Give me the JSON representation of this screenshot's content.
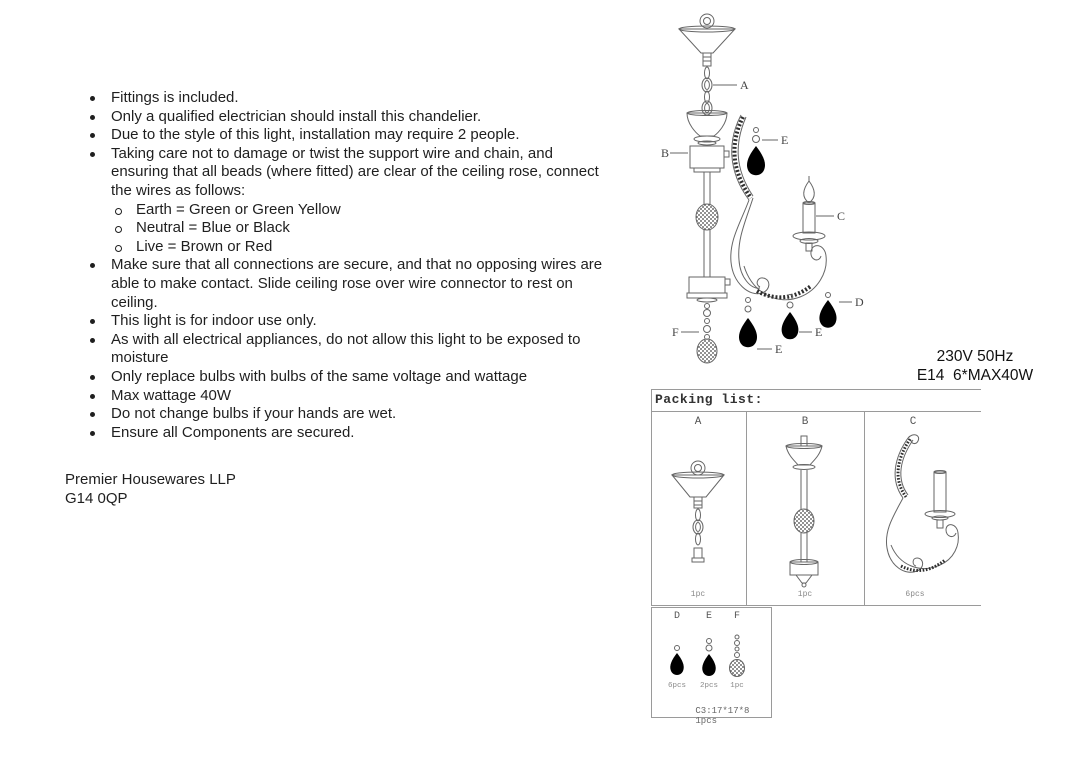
{
  "instructions": {
    "bullets": [
      {
        "text": "Fittings is included."
      },
      {
        "text": "Only a qualified electrician should install this chandelier."
      },
      {
        "text": "Due to the style of this light, installation may require 2 people."
      },
      {
        "text": "Taking care not to damage or twist the support wire and chain, and\nensuring that all beads (where fitted) are clear of the ceiling rose, connect\nthe wires as follows:",
        "sub": [
          "Earth = Green or Green Yellow",
          "Neutral = Blue or Black",
          "Live = Brown or Red"
        ]
      },
      {
        "text": "Make sure that all connections are secure, and that no opposing wires are\nable to make contact. Slide ceiling rose over wire connector to rest on\nceiling."
      },
      {
        "text": "This light is for indoor use only."
      },
      {
        "text": "As with all electrical appliances, do not allow this light to be exposed to\nmoisture"
      },
      {
        "text": "Only replace bulbs with bulbs of the same voltage and wattage"
      },
      {
        "text": "Max wattage 40W"
      },
      {
        "text": "Do not change bulbs if your hands are wet."
      },
      {
        "text": "Ensure all Components are secured."
      }
    ]
  },
  "footer": {
    "company": "Premier Housewares LLP",
    "postcode": "G14 0QP"
  },
  "specs": {
    "voltage": "230V 50Hz",
    "bulb": "E14  6*MAX40W"
  },
  "diagram": {
    "labels": {
      "a": "A",
      "b": "B",
      "c": "C",
      "d": "D",
      "e": "E",
      "e2": "E",
      "e_top": "E",
      "f": "F"
    }
  },
  "packing_list": {
    "title": "Packing list:",
    "columns": [
      {
        "part": "A",
        "qty": "1pc"
      },
      {
        "part": "B",
        "qty": "1pc"
      },
      {
        "part": "C",
        "qty": "6pcs"
      }
    ],
    "small_parts": [
      {
        "part": "D",
        "qty": "6pcs"
      },
      {
        "part": "E",
        "qty": "2pcs"
      },
      {
        "part": "F",
        "qty": "1pc"
      }
    ],
    "box_size": "C3:17*17*8",
    "box_qty": "1pcs"
  }
}
